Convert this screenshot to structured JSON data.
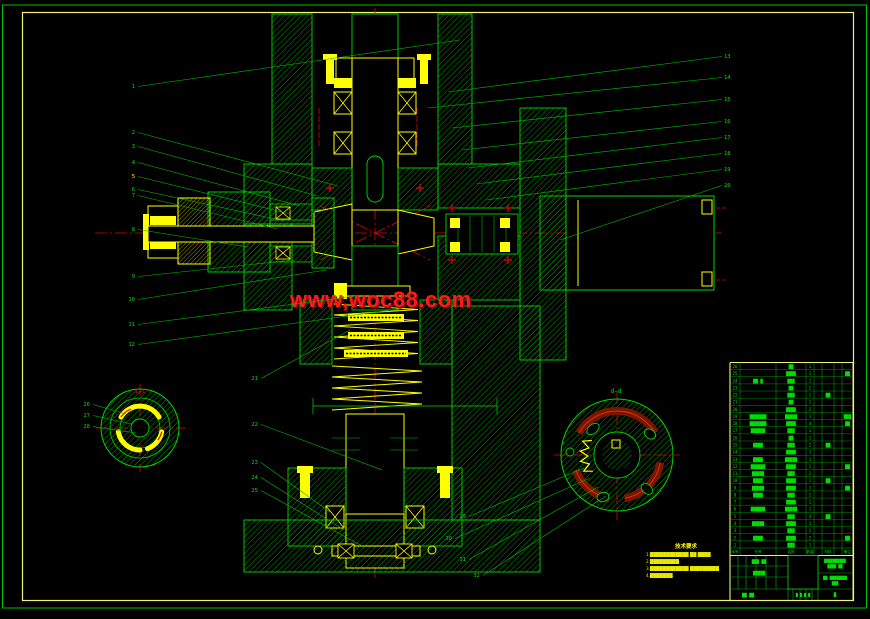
{
  "colors": {
    "line_green": "#00e000",
    "hatch_green": "#009900",
    "detail_yellow": "#ffff00",
    "border_yellow": "#f3f37a",
    "center_red": "#e60000",
    "slot_dark_red": "#7a1600",
    "watermark_red": "#ff1a1a"
  },
  "watermark": {
    "text": "www,woc88.com"
  },
  "section_labels": {
    "left": "I—I",
    "right": "d—d"
  },
  "notes": {
    "title": "技术要求",
    "lines": [
      "1.████████████ ██ ████.",
      "2.█████████.",
      "3.████████████ █████████.",
      "4.███████."
    ]
  },
  "callouts": [
    {
      "l": "1",
      "x": 135,
      "y": 88,
      "tx": 460,
      "ty": 40
    },
    {
      "l": "2",
      "x": 135,
      "y": 134,
      "tx": 338,
      "ty": 186
    },
    {
      "l": "3",
      "x": 135,
      "y": 148,
      "tx": 318,
      "ty": 196
    },
    {
      "l": "4",
      "x": 135,
      "y": 164,
      "tx": 300,
      "ty": 206
    },
    {
      "l": "5",
      "x": 135,
      "y": 178,
      "tx": 290,
      "ty": 214,
      "c": "#ffff00"
    },
    {
      "l": "6",
      "x": 135,
      "y": 191,
      "tx": 284,
      "ty": 221
    },
    {
      "l": "7",
      "x": 135,
      "y": 197,
      "tx": 278,
      "ty": 229
    },
    {
      "l": "8",
      "x": 135,
      "y": 231,
      "tx": 248,
      "ty": 247
    },
    {
      "l": "9",
      "x": 135,
      "y": 278,
      "tx": 294,
      "ty": 260
    },
    {
      "l": "10",
      "x": 135,
      "y": 301,
      "tx": 326,
      "ty": 270
    },
    {
      "l": "11",
      "x": 135,
      "y": 326,
      "tx": 356,
      "ty": 296
    },
    {
      "l": "12",
      "x": 135,
      "y": 346,
      "tx": 392,
      "ty": 310
    },
    {
      "l": "13",
      "x": 722,
      "y": 58,
      "tx": 448,
      "ty": 92
    },
    {
      "l": "14",
      "x": 722,
      "y": 79,
      "tx": 428,
      "ty": 108
    },
    {
      "l": "15",
      "x": 722,
      "y": 101,
      "tx": 452,
      "ty": 128
    },
    {
      "l": "16",
      "x": 722,
      "y": 123,
      "tx": 462,
      "ty": 150
    },
    {
      "l": "17",
      "x": 722,
      "y": 139,
      "tx": 468,
      "ty": 168
    },
    {
      "l": "18",
      "x": 722,
      "y": 155,
      "tx": 476,
      "ty": 184
    },
    {
      "l": "19",
      "x": 722,
      "y": 171,
      "tx": 486,
      "ty": 200
    },
    {
      "l": "20",
      "x": 722,
      "y": 187,
      "tx": 560,
      "ty": 240
    },
    {
      "l": "21",
      "x": 258,
      "y": 380,
      "tx": 350,
      "ty": 330
    },
    {
      "l": "22",
      "x": 258,
      "y": 426,
      "tx": 382,
      "ty": 470
    },
    {
      "l": "23",
      "x": 258,
      "y": 464,
      "tx": 330,
      "ty": 512
    },
    {
      "l": "24",
      "x": 258,
      "y": 479,
      "tx": 344,
      "ty": 530
    },
    {
      "l": "25",
      "x": 258,
      "y": 492,
      "tx": 362,
      "ty": 546
    },
    {
      "l": "26",
      "x": 90,
      "y": 406,
      "tx": 126,
      "ty": 414
    },
    {
      "l": "27",
      "x": 90,
      "y": 417,
      "tx": 131,
      "ty": 424
    },
    {
      "l": "28",
      "x": 90,
      "y": 428,
      "tx": 136,
      "ty": 433
    },
    {
      "l": "29",
      "x": 466,
      "y": 518,
      "tx": 584,
      "ty": 468
    },
    {
      "l": "30",
      "x": 452,
      "y": 540,
      "tx": 590,
      "ty": 478
    },
    {
      "l": "31",
      "x": 466,
      "y": 561,
      "tx": 598,
      "ty": 487
    },
    {
      "l": "32",
      "x": 480,
      "y": 577,
      "tx": 606,
      "ty": 496
    }
  ],
  "bom": {
    "headers": [
      "序号",
      "代号",
      "名称",
      "数量",
      "材料",
      "备注"
    ],
    "rows": [
      {
        "n": "26",
        "code": "",
        "name": "██",
        "qty": "1",
        "mat": "",
        "rem": ""
      },
      {
        "n": "25",
        "code": "",
        "name": "████",
        "qty": "1",
        "mat": "",
        "rem": "██"
      },
      {
        "n": "24",
        "code": "██ █",
        "name": "███",
        "qty": "1",
        "mat": "",
        "rem": ""
      },
      {
        "n": "23",
        "code": "",
        "name": "██",
        "qty": "2",
        "mat": "",
        "rem": ""
      },
      {
        "n": "22",
        "code": "",
        "name": "███",
        "qty": "1",
        "mat": "██",
        "rem": ""
      },
      {
        "n": "21",
        "code": "",
        "name": "██",
        "qty": "1",
        "mat": "",
        "rem": ""
      },
      {
        "n": "20",
        "code": "",
        "name": "████",
        "qty": "2",
        "mat": "",
        "rem": ""
      },
      {
        "n": "19",
        "code": "███████",
        "name": "█████",
        "qty": "1",
        "mat": "",
        "rem": "███"
      },
      {
        "n": "18",
        "code": "███████",
        "name": "████",
        "qty": "4",
        "mat": "",
        "rem": "██"
      },
      {
        "n": "17",
        "code": "██████",
        "name": "███",
        "qty": "1",
        "mat": "",
        "rem": ""
      },
      {
        "n": "16",
        "code": "",
        "name": "██",
        "qty": "1",
        "mat": "",
        "rem": ""
      },
      {
        "n": "15",
        "code": "████",
        "name": "███",
        "qty": "2",
        "mat": "██",
        "rem": ""
      },
      {
        "n": "14",
        "code": "",
        "name": "████",
        "qty": "1",
        "mat": "",
        "rem": ""
      },
      {
        "n": "13",
        "code": "████",
        "name": "█████",
        "qty": "1",
        "mat": "",
        "rem": ""
      },
      {
        "n": "12",
        "code": "██████",
        "name": "████",
        "qty": "1",
        "mat": "",
        "rem": "██"
      },
      {
        "n": "11",
        "code": "█████",
        "name": "███",
        "qty": "2",
        "mat": "",
        "rem": ""
      },
      {
        "n": "10",
        "code": "████",
        "name": "████",
        "qty": "1",
        "mat": "██",
        "rem": ""
      },
      {
        "n": "9",
        "code": "█████",
        "name": "████",
        "qty": "1",
        "mat": "",
        "rem": "██"
      },
      {
        "n": "8",
        "code": "████",
        "name": "███",
        "qty": "2",
        "mat": "",
        "rem": ""
      },
      {
        "n": "7",
        "code": "",
        "name": "████",
        "qty": "1",
        "mat": "",
        "rem": ""
      },
      {
        "n": "6",
        "code": "██████",
        "name": "█████",
        "qty": "1",
        "mat": "",
        "rem": ""
      },
      {
        "n": "5",
        "code": "",
        "name": "███",
        "qty": "4",
        "mat": "██",
        "rem": ""
      },
      {
        "n": "4",
        "code": "█████",
        "name": "████",
        "qty": "1",
        "mat": "",
        "rem": ""
      },
      {
        "n": "3",
        "code": "",
        "name": "███",
        "qty": "1",
        "mat": "",
        "rem": ""
      },
      {
        "n": "2",
        "code": "████",
        "name": "████",
        "qty": "2",
        "mat": "",
        "rem": "██"
      },
      {
        "n": "1",
        "code": "",
        "name": "███",
        "qty": "1",
        "mat": "",
        "rem": ""
      }
    ]
  },
  "tb": {
    "a": "███ ██",
    "b": "█████",
    "c": "██ ██",
    "d1": "██████████",
    "d2": "████ ██",
    "e1": "██-████████",
    "e2": "███",
    "f": "█",
    "g": "█ █ █ █"
  }
}
